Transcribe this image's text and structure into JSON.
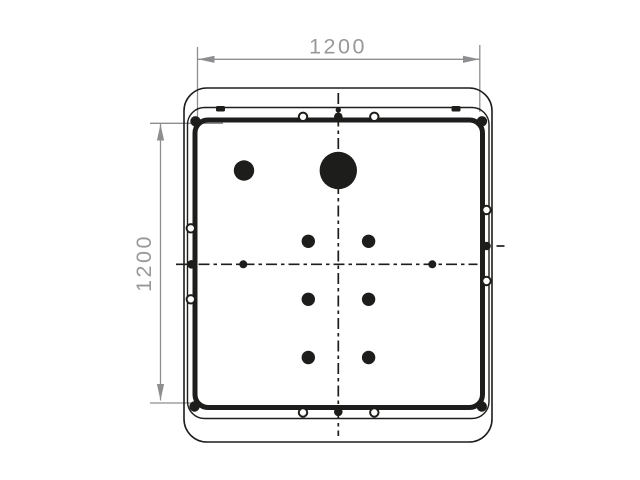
{
  "drawing": {
    "type": "technical-drawing-panel-top-view",
    "dimensions": {
      "width_label": "1200",
      "height_label": "1200"
    },
    "colors": {
      "line": "#1d1d1b",
      "dimension_line": "#8e8e90",
      "dimension_text": "#98989b",
      "background": "#ffffff"
    }
  }
}
